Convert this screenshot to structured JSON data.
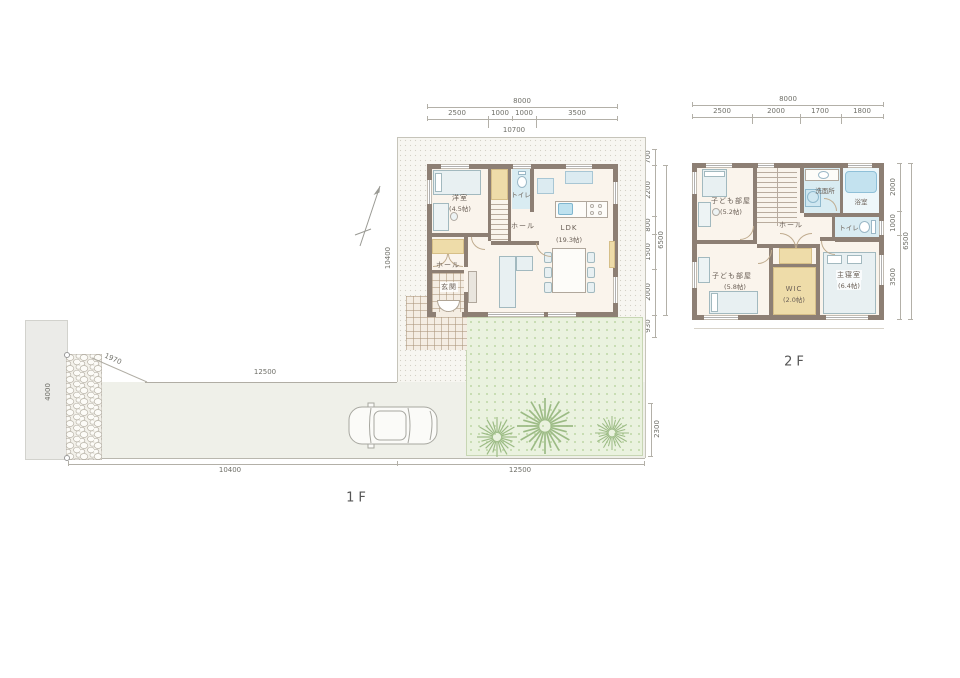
{
  "floor1": {
    "label": "1F",
    "rooms": {
      "bedroom": {
        "name": "洋室",
        "size": "(4.5帖)"
      },
      "toilet": {
        "name": "トイレ"
      },
      "hall_upper": {
        "name": "ホール"
      },
      "ldk": {
        "name": "LDK",
        "size": "(19.3帖)"
      },
      "hall_lower": {
        "name": "ホール"
      },
      "entrance": {
        "name": "玄関"
      }
    },
    "dims": {
      "top_total": "8000",
      "top_segments": [
        "2500",
        "1000",
        "1000",
        "3500"
      ],
      "top_sub": "10700",
      "right_pre": "700",
      "right_segments": [
        "2200",
        "800",
        "1500",
        "2000"
      ],
      "right_total": "6500",
      "right_post": "930",
      "road_width": "4000",
      "wall_diagonal": "1970",
      "drive_top": "12500",
      "site_left": "10400",
      "bottom_left": "10400",
      "bottom_right": "12500",
      "garden_right": "2300"
    }
  },
  "floor2": {
    "label": "2F",
    "rooms": {
      "kids1": {
        "name": "子ども部屋",
        "size": "(5.2帖)"
      },
      "washroom": {
        "name": "洗面所"
      },
      "bath": {
        "name": "浴室"
      },
      "toilet": {
        "name": "トイレ"
      },
      "hall": {
        "name": "ホール"
      },
      "kids2": {
        "name": "子ども部屋",
        "size": "(5.8帖)"
      },
      "wic": {
        "name": "WIC",
        "size": "(2.0帖)"
      },
      "master": {
        "name": "主寝室",
        "size": "(6.4帖)"
      }
    },
    "dims": {
      "top_total": "8000",
      "top_segments": [
        "2500",
        "2000",
        "1700",
        "1800"
      ],
      "right_segments": [
        "2000",
        "1000",
        "3500"
      ],
      "right_total": "6500"
    }
  },
  "colors": {
    "wall": "#8d7f74",
    "tatami": "#eedca9",
    "wet_area": "#d9ecf2",
    "garden": "#eaf2df",
    "floor": "#faf4ec"
  }
}
